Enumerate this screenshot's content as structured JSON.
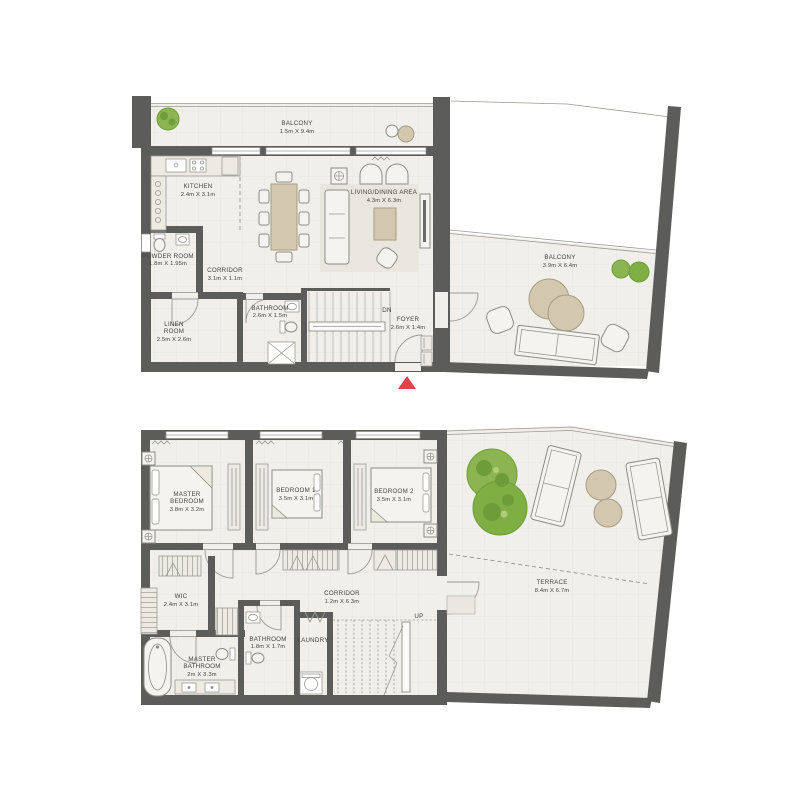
{
  "colors": {
    "wall": "#5c5c5a",
    "floor": "#f0efe9",
    "furniture_tan": "#d3c8af",
    "plant_green_light": "#8cb551",
    "plant_green_dark": "#6d9c39",
    "entry_marker_red": "#e2414b",
    "label_text": "#45453f"
  },
  "upper_floor": {
    "balcony_top": {
      "name": "BALCONY",
      "dims": "1.5m X 9.4m"
    },
    "kitchen": {
      "name": "KITCHEN",
      "dims": "2.4m X 3.1m"
    },
    "living_dining": {
      "name": "LIVING/DINING AREA",
      "dims": "4.3m X 6.3m"
    },
    "powder_room": {
      "name": "POWDER ROOM",
      "dims": "1.8m X 1.95m"
    },
    "corridor": {
      "name": "CORRIDOR",
      "dims": "3.1m X 1.1m"
    },
    "linen_room": {
      "line1": "LINEN",
      "line2": "ROOM",
      "dims": "2.5m X 2.6m"
    },
    "bathroom": {
      "name": "BATHROOM",
      "dims": "2.6m X 1.5m"
    },
    "foyer": {
      "name": "FOYER",
      "dims": "2.6m X 1.4m"
    },
    "stairs_label": "DN",
    "balcony_side": {
      "name": "BALCONY",
      "dims": "3.9m X 6.4m"
    }
  },
  "lower_floor": {
    "master_bedroom": {
      "line1": "MASTER",
      "line2": "BEDROOM",
      "dims": "3.8m X 3.2m"
    },
    "bedroom1": {
      "name": "BEDROOM 1",
      "dims": "3.5m X 3.1m"
    },
    "bedroom2": {
      "name": "BEDROOM 2",
      "dims": "3.5m X 3.1m"
    },
    "wic": {
      "name": "WIC",
      "dims": "2.4m X 3.1m"
    },
    "corridor": {
      "name": "CORRIDOR",
      "dims": "1.2m X 6.3m"
    },
    "bathroom": {
      "name": "BATHROOM",
      "dims": "1.8m X 1.7m"
    },
    "laundry": {
      "name": "LAUNDRY"
    },
    "master_bathroom": {
      "line1": "MASTER",
      "line2": "BATHROOM",
      "dims": "2m X 3.3m"
    },
    "stairs_label": "UP",
    "terrace": {
      "name": "TERRACE",
      "dims": "8.4m X 6.7m"
    }
  }
}
